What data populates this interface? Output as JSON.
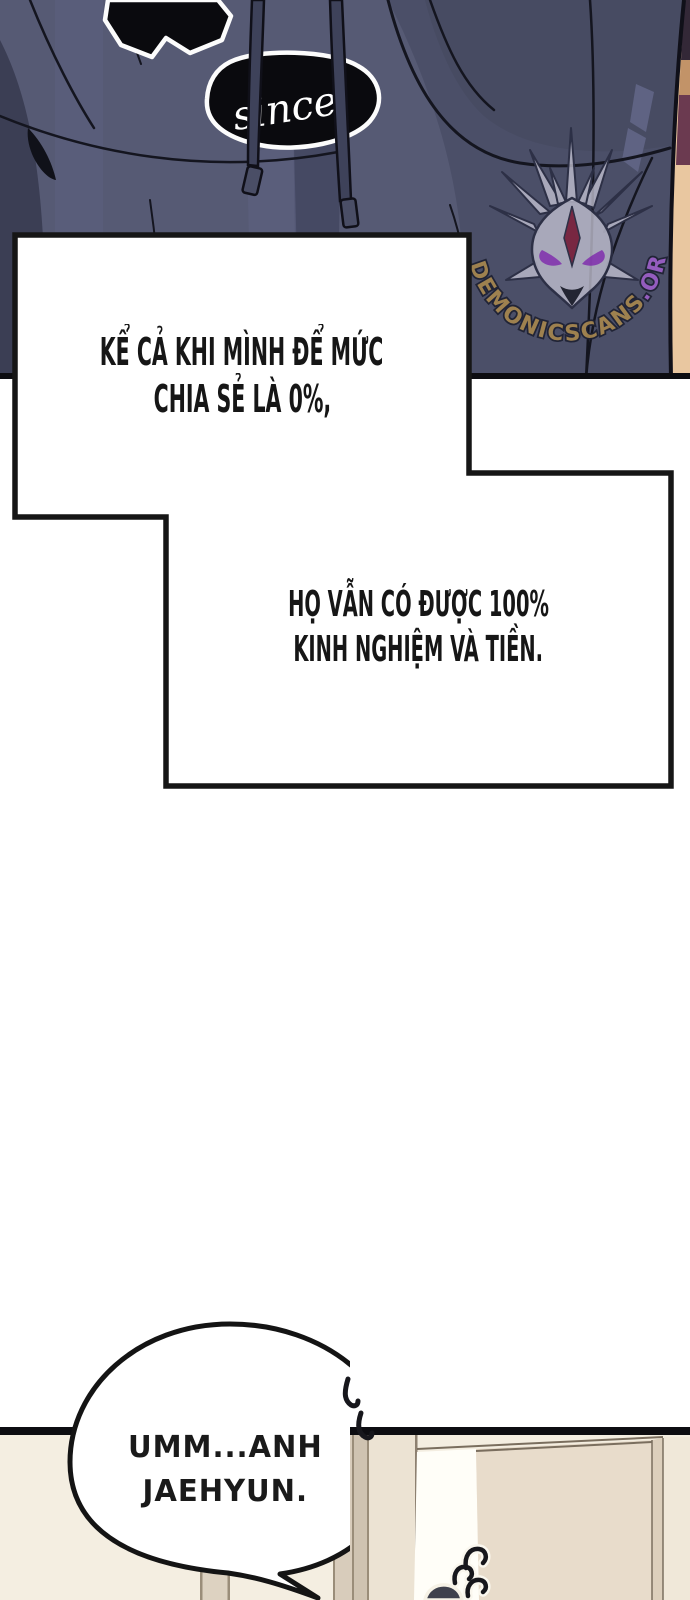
{
  "page": {
    "width": 690,
    "height": 1600,
    "background": "#ffffff"
  },
  "top_panel": {
    "description": "close-up of dark slate-blue hoodie with two drawstrings, torn black patches, arm sliver at right edge",
    "patch_text": "since",
    "colors": {
      "hoodie_base": "#565a74",
      "hoodie_dark": "#4b4f68",
      "hoodie_darker": "#454963",
      "hoodie_shadow": "#3b3e54",
      "hoodie_light": "#5e6283",
      "outline": "#14151f",
      "patch_fill": "#0a0a0e",
      "patch_outline": "#fcfcfc",
      "cord": "#3e425a",
      "skin": "#e9c7a0",
      "skin_shadow": "#c29368",
      "maroon": "#6b3a50",
      "border": "#0d0d11"
    },
    "watermark": {
      "text_main": "DEMONICSCANS",
      "text_tld": ".ORG",
      "main_color": "#a5854e",
      "tld_color": "#9a5ec5",
      "emblem": "demonic-dragon-head",
      "emblem_fill": "#c6c4d4",
      "emblem_outline": "#2b2e44",
      "eye_color": "#8b3fb5",
      "gem_color": "#7c2440"
    }
  },
  "caption_boxes": {
    "fill": "#ffffff",
    "border_color": "#161616",
    "text_color": "#161616",
    "box1": {
      "lines": [
        "KỂ CẢ KHI MÌNH ĐỂ MỨC",
        "CHIA SẺ LÀ 0%,"
      ]
    },
    "box2": {
      "lines": [
        "HỌ VẪN CÓ ĐƯỢC 100%",
        "KINH NGHIỆM VÀ TIỀN."
      ]
    }
  },
  "speech_bubble": {
    "lines": [
      "UMM...ANH",
      "JAEHYUN."
    ],
    "fill": "#ffffff",
    "stroke": "#141414"
  },
  "bottom_panel": {
    "description": "room interior with partially open door, small curl marks, top of dark-haired head peeking from bottom edge",
    "colors": {
      "bar": "#0d0d11",
      "wall": "#f4eee1",
      "door_face": "#e8dccb",
      "door_edge_strip": "#dccfbc",
      "door_right_wall": "#f0e8d9",
      "door_gap": "#fffef8",
      "jamb_a": "#ddd2c1",
      "jamb_b": "#d8ccbb",
      "jamb_c": "#cfc3b1",
      "jamb_d": "#ece3d3",
      "frame_line": "#7a6e5e",
      "hair": "#3f414d"
    }
  }
}
